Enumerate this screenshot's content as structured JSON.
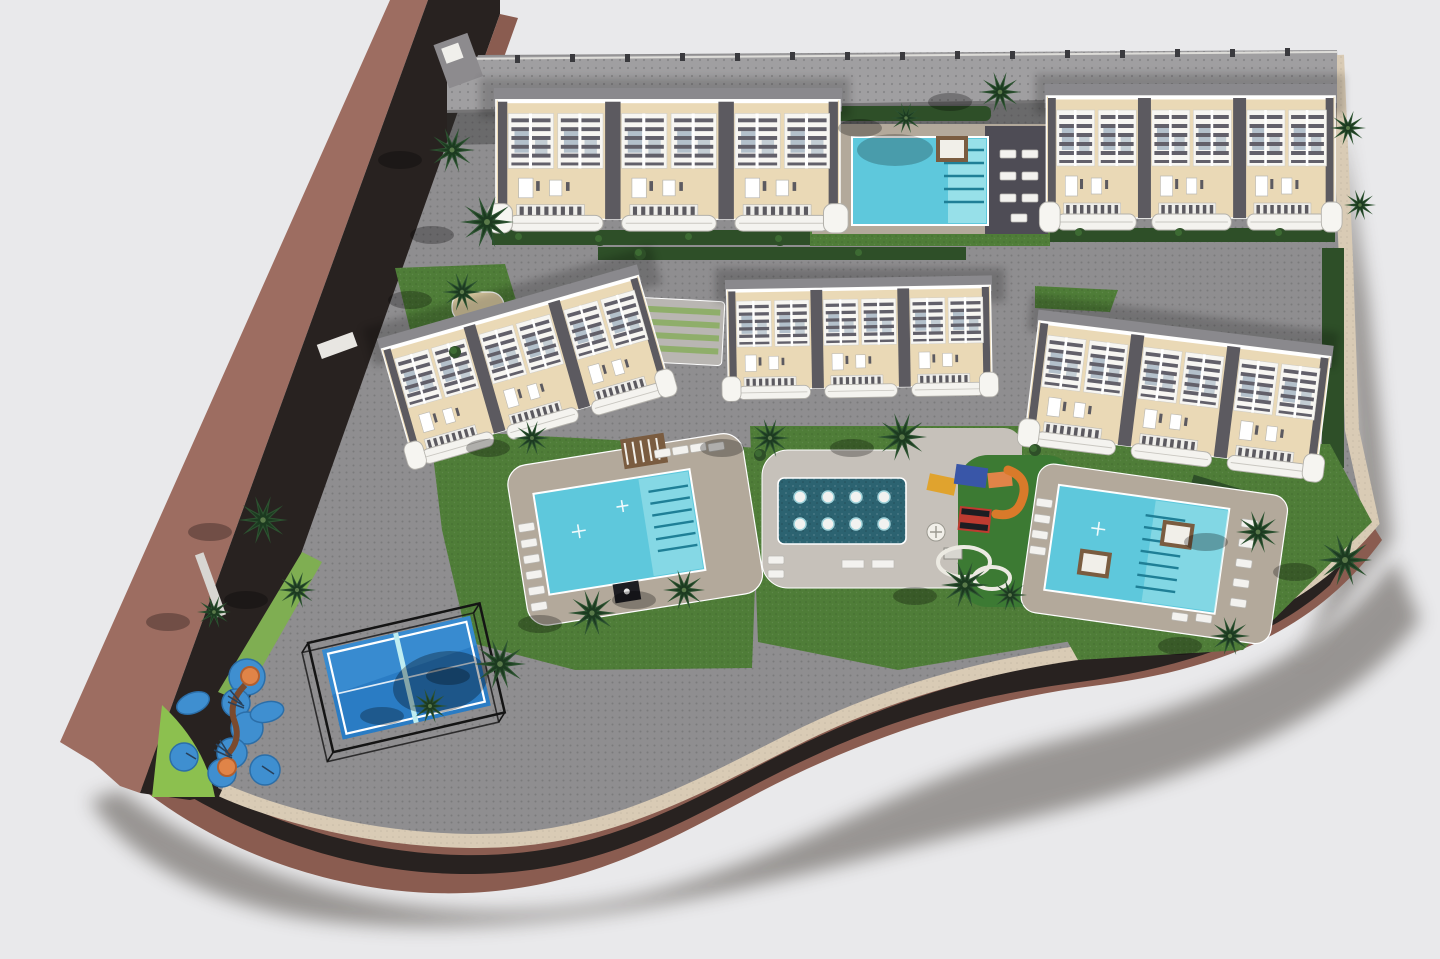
{
  "scene": {
    "type": "aerial-3d-architectural-site-plan-render",
    "description": "Bird's-eye 3D render of a residential complex: five beige apartment blocks with white pergola roof terraces, a shared pool between the two top blocks, two large communal pools, a central jet spa pool with playground, a paddle tennis court, a kids' water splash park, palm trees and lawns, all bounded by a diagonal road on the left and an S-curved road along the bottom",
    "counts": {
      "apartment_blocks": 5,
      "large_pools": 3,
      "jet_spa_pool": 1,
      "paddle_court": 1,
      "kids_splash_park": 1,
      "playground": 1
    }
  },
  "colors": {
    "background": "#e9e9eb",
    "road_asphalt": "#282220",
    "road_asphalt_soft": "#3a322d",
    "sidewalk_brown": "#9d6d61",
    "sidewalk_brown_dark": "#8a5c50",
    "curb_beige": "#d9cbb5",
    "paver_gray": "#8f8e90",
    "paver_light": "#a09fa1",
    "grass": "#4f7d38",
    "grass_bright": "#8cc04f",
    "grass_verge": "#7fae52",
    "hedge": "#2e4f28",
    "palm": "#2c5230",
    "pool_water": "#5ec8dc",
    "pool_water_light": "#a5e6ec",
    "pool_step": "#1f7f96",
    "jet_pool": "#2c6371",
    "deck_tan": "#b3a99b",
    "deck_concrete": "#c6c1ba",
    "deck_dark": "#4e4c55",
    "building_roof": "#ead9b6",
    "building_white": "#f6f5f1",
    "building_gray_band": "#8a898d",
    "building_divider": "#5c5a60",
    "building_slat": "#62606a",
    "building_glass": "#8fa3b5",
    "wood_brown": "#7a5c40",
    "paddle_blue": "#2a7cc4",
    "paddle_blue_light": "#3b8ed2",
    "paddle_net": "#bfeef2",
    "splash_blue": "#3f8fd0",
    "play_orange": "#e08448",
    "play_red": "#bf3b30",
    "play_yellow": "#e0a32e",
    "play_navy": "#3956a8",
    "sand": "#d9c9a0",
    "shadow_dark": "#55504a"
  }
}
